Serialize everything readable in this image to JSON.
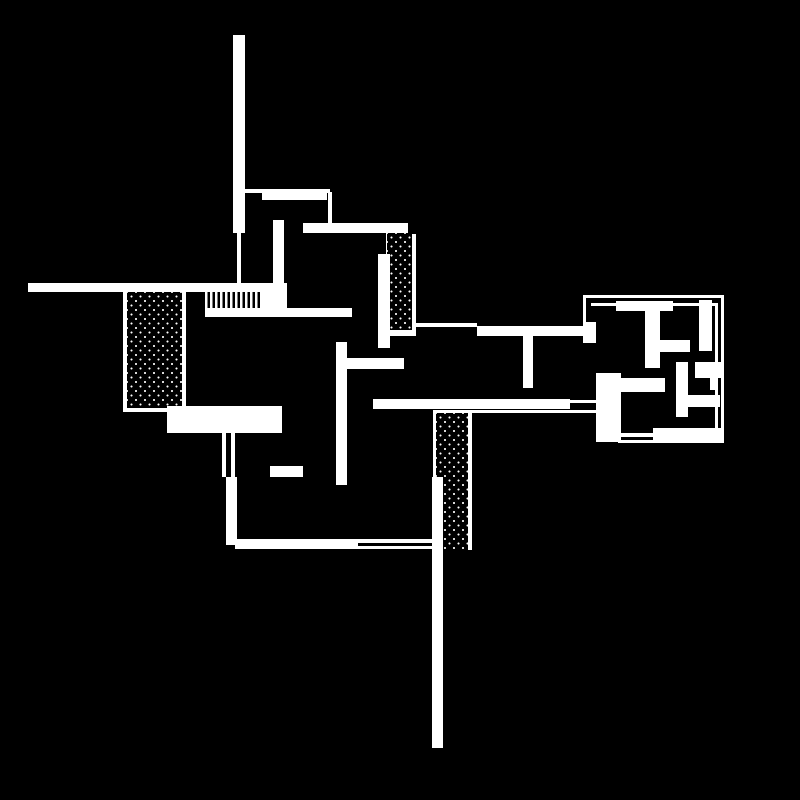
{
  "canvas": {
    "width": 800,
    "height": 800,
    "background_color": "#000000",
    "ink_color": "#ffffff",
    "description": "black-and-white architectural floor plan drawing"
  },
  "drawing": {
    "shapes": [
      {
        "name": "chimney-bar-top",
        "type": "solid",
        "x": 233,
        "y": 35,
        "w": 12,
        "h": 198
      },
      {
        "name": "chimney-stem-line",
        "type": "solid",
        "x": 237,
        "y": 233,
        "w": 4,
        "h": 51
      },
      {
        "name": "north-thin-wall",
        "type": "solid",
        "x": 245,
        "y": 189,
        "w": 85,
        "h": 4
      },
      {
        "name": "north-inner-bar",
        "type": "solid",
        "x": 262,
        "y": 193,
        "w": 65,
        "h": 7
      },
      {
        "name": "north-connector-line",
        "type": "solid",
        "x": 328,
        "y": 192,
        "w": 4,
        "h": 33
      },
      {
        "name": "upper-terrace-bar",
        "type": "solid",
        "x": 303,
        "y": 223,
        "w": 105,
        "h": 10
      },
      {
        "name": "upper-interior-wall",
        "type": "solid",
        "x": 273,
        "y": 220,
        "w": 11,
        "h": 72
      },
      {
        "name": "west-long-wall",
        "type": "solid",
        "x": 28,
        "y": 283,
        "w": 245,
        "h": 9
      },
      {
        "name": "stair-connector",
        "type": "solid",
        "x": 260,
        "y": 283,
        "w": 27,
        "h": 27
      },
      {
        "name": "stair-comb",
        "type": "comb",
        "x": 205,
        "y": 291,
        "w": 54,
        "h": 17
      },
      {
        "name": "stair-base-bar",
        "type": "solid",
        "x": 205,
        "y": 308,
        "w": 147,
        "h": 9
      },
      {
        "name": "west-stipple-border-left",
        "type": "solid",
        "x": 123,
        "y": 292,
        "w": 4,
        "h": 120
      },
      {
        "name": "west-stipple-border-right",
        "type": "solid",
        "x": 182,
        "y": 292,
        "w": 4,
        "h": 120
      },
      {
        "name": "west-stipple-border-bottom",
        "type": "solid",
        "x": 123,
        "y": 408,
        "w": 63,
        "h": 4
      },
      {
        "name": "west-stipple-fill",
        "type": "stipple",
        "x": 127,
        "y": 292,
        "w": 55,
        "h": 116
      },
      {
        "name": "north-stipple-border-left",
        "type": "solid",
        "x": 386,
        "y": 233,
        "w": 3,
        "h": 25
      },
      {
        "name": "north-stipple-border-right",
        "type": "solid",
        "x": 412,
        "y": 234,
        "w": 4,
        "h": 96
      },
      {
        "name": "north-stipple-border-bottom",
        "type": "solid",
        "x": 387,
        "y": 330,
        "w": 29,
        "h": 6
      },
      {
        "name": "north-stipple-fill",
        "type": "stipple",
        "x": 387,
        "y": 233,
        "w": 25,
        "h": 97
      },
      {
        "name": "central-vert-bar",
        "type": "solid",
        "x": 378,
        "y": 254,
        "w": 12,
        "h": 94
      },
      {
        "name": "mid-thin-wall",
        "type": "solid",
        "x": 412,
        "y": 323,
        "w": 65,
        "h": 4
      },
      {
        "name": "mid-entry-bar",
        "type": "solid",
        "x": 477,
        "y": 326,
        "w": 119,
        "h": 10
      },
      {
        "name": "mid-t-stem",
        "type": "solid",
        "x": 523,
        "y": 336,
        "w": 10,
        "h": 52
      },
      {
        "name": "south-interior-wall",
        "type": "solid",
        "x": 336,
        "y": 342,
        "w": 11,
        "h": 143
      },
      {
        "name": "south-interior-bar",
        "type": "solid",
        "x": 347,
        "y": 358,
        "w": 57,
        "h": 11
      },
      {
        "name": "south-long-wall",
        "type": "solid",
        "x": 373,
        "y": 399,
        "w": 197,
        "h": 10
      },
      {
        "name": "south-wall-line-upper",
        "type": "solid",
        "x": 570,
        "y": 400,
        "w": 26,
        "h": 3
      },
      {
        "name": "south-wall-line-lower",
        "type": "solid",
        "x": 436,
        "y": 410,
        "w": 160,
        "h": 3
      },
      {
        "name": "west-big-block",
        "type": "solid",
        "x": 167,
        "y": 406,
        "w": 115,
        "h": 27
      },
      {
        "name": "west-thin-line-a",
        "type": "solid",
        "x": 222,
        "y": 433,
        "w": 4,
        "h": 44
      },
      {
        "name": "west-thin-line-b",
        "type": "solid",
        "x": 231,
        "y": 433,
        "w": 4,
        "h": 44
      },
      {
        "name": "west-lower-bar",
        "type": "solid",
        "x": 226,
        "y": 477,
        "w": 11,
        "h": 68
      },
      {
        "name": "small-dash",
        "type": "solid",
        "x": 270,
        "y": 466,
        "w": 33,
        "h": 11
      },
      {
        "name": "bottom-wall-bar",
        "type": "solid",
        "x": 235,
        "y": 539,
        "w": 123,
        "h": 10
      },
      {
        "name": "bottom-wall-line-a",
        "type": "solid",
        "x": 358,
        "y": 539,
        "w": 85,
        "h": 4
      },
      {
        "name": "bottom-wall-line-b",
        "type": "solid",
        "x": 358,
        "y": 546,
        "w": 75,
        "h": 3
      },
      {
        "name": "south-stipple-border-top",
        "type": "solid",
        "x": 433,
        "y": 410,
        "w": 39,
        "h": 3
      },
      {
        "name": "south-stipple-border-left",
        "type": "solid",
        "x": 433,
        "y": 413,
        "w": 3,
        "h": 64
      },
      {
        "name": "south-stipple-border-right",
        "type": "solid",
        "x": 468,
        "y": 413,
        "w": 4,
        "h": 137
      },
      {
        "name": "south-stipple-fill",
        "type": "stipple",
        "x": 436,
        "y": 413,
        "w": 32,
        "h": 137
      },
      {
        "name": "south-long-spine",
        "type": "solid",
        "x": 432,
        "y": 477,
        "w": 11,
        "h": 271
      },
      {
        "name": "east-outline-top-outer",
        "type": "solid",
        "x": 583,
        "y": 295,
        "w": 141,
        "h": 3
      },
      {
        "name": "east-outline-top-inner",
        "type": "solid",
        "x": 591,
        "y": 303,
        "w": 127,
        "h": 3
      },
      {
        "name": "east-outline-left",
        "type": "solid",
        "x": 583,
        "y": 295,
        "w": 3,
        "h": 32
      },
      {
        "name": "east-outline-right-inner",
        "type": "solid",
        "x": 715,
        "y": 303,
        "w": 3,
        "h": 140
      },
      {
        "name": "east-outline-right-outer",
        "type": "solid",
        "x": 721,
        "y": 295,
        "w": 3,
        "h": 148
      },
      {
        "name": "east-outline-bottom",
        "type": "solid",
        "x": 618,
        "y": 440,
        "w": 106,
        "h": 3
      },
      {
        "name": "east-entry-block",
        "type": "solid",
        "x": 583,
        "y": 322,
        "w": 13,
        "h": 21
      },
      {
        "name": "east-top-bar",
        "type": "solid",
        "x": 616,
        "y": 301,
        "w": 57,
        "h": 10
      },
      {
        "name": "east-t-stem",
        "type": "solid",
        "x": 645,
        "y": 311,
        "w": 15,
        "h": 57
      },
      {
        "name": "east-mid-bar",
        "type": "solid",
        "x": 660,
        "y": 340,
        "w": 30,
        "h": 12
      },
      {
        "name": "east-right-bar",
        "type": "solid",
        "x": 699,
        "y": 300,
        "w": 13,
        "h": 51
      },
      {
        "name": "east-small-square",
        "type": "solid",
        "x": 695,
        "y": 362,
        "w": 28,
        "h": 16
      },
      {
        "name": "east-small-stub",
        "type": "solid",
        "x": 710,
        "y": 378,
        "w": 8,
        "h": 12
      },
      {
        "name": "east-mid-wall",
        "type": "solid",
        "x": 676,
        "y": 362,
        "w": 12,
        "h": 55
      },
      {
        "name": "east-left-block",
        "type": "solid",
        "x": 596,
        "y": 373,
        "w": 25,
        "h": 69
      },
      {
        "name": "east-left-arm",
        "type": "solid",
        "x": 621,
        "y": 378,
        "w": 44,
        "h": 14
      },
      {
        "name": "east-right-bar2",
        "type": "solid",
        "x": 688,
        "y": 395,
        "w": 32,
        "h": 12
      },
      {
        "name": "east-bottom-bar",
        "type": "solid",
        "x": 653,
        "y": 428,
        "w": 69,
        "h": 12
      },
      {
        "name": "east-bottom-line",
        "type": "solid",
        "x": 618,
        "y": 433,
        "w": 35,
        "h": 4
      }
    ]
  }
}
